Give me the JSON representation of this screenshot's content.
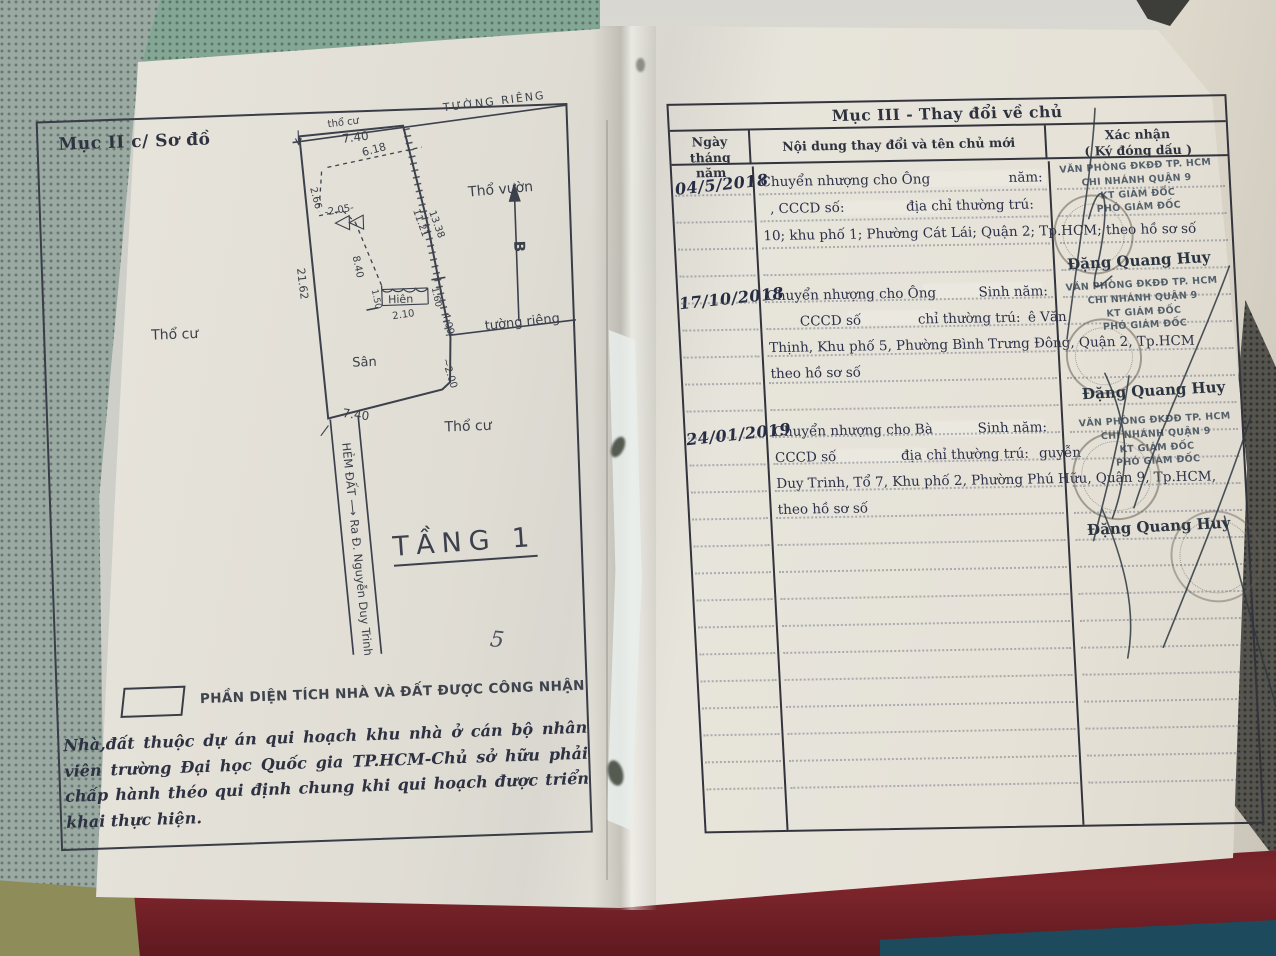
{
  "document_type": "Vietnamese land-use certificate, open booklet photo",
  "colors": {
    "paper": "#e6e2d8",
    "ink": "#2c3048",
    "table_border": "#33343d",
    "stamp_ink": "#40515c",
    "mesh_fabric": "#84a795",
    "red_cloth": "#7e262c",
    "olive_patch": "#8e8c59",
    "teal_patch": "#1d4a5c"
  },
  "left_page": {
    "section_heading": "Mục II c/ Sơ đồ",
    "floor_label": "TẦNG 1",
    "legend_label": "PHẦN DIỆN TÍCH NHÀ VÀ ĐẤT ĐƯỢC CÔNG NHẬN",
    "note": "Nhà,đất thuộc dự án qui hoạch khu nhà ở cán bộ nhân viên trường Đại học Quốc gia TP.HCM-Chủ sở hữu phải chấp hành théo qui định chung khi qui hoạch được triển khai thực hiện.",
    "pen_mark": "5",
    "diagram_labels": [
      {
        "text": "thổ cư",
        "x": 292,
        "y": 32,
        "r": -5,
        "s": 10
      },
      {
        "text": "7.40",
        "x": 306,
        "y": 48,
        "r": -5,
        "s": 12
      },
      {
        "text": "TƯỜNG RIÊNG",
        "x": 408,
        "y": 20,
        "r": -5,
        "s": 11,
        "ls": 2
      },
      {
        "text": "6.18",
        "x": 326,
        "y": 62,
        "r": -13,
        "s": 11
      },
      {
        "text": "2.66",
        "x": 272,
        "y": 92,
        "r": 78,
        "s": 10
      },
      {
        "text": "-2.05-",
        "x": 286,
        "y": 120,
        "r": -8,
        "s": 10
      },
      {
        "text": "8.40",
        "x": 312,
        "y": 162,
        "r": 80,
        "s": 10
      },
      {
        "text": "21.62",
        "x": 256,
        "y": 172,
        "r": 85,
        "s": 11
      },
      {
        "text": "11.21",
        "x": 374,
        "y": 118,
        "r": 72,
        "s": 10
      },
      {
        "text": "13.38",
        "x": 390,
        "y": 120,
        "r": 72,
        "s": 10
      },
      {
        "text": "Thổ vườn",
        "x": 430,
        "y": 106,
        "r": -3,
        "s": 14
      },
      {
        "text": "B",
        "x": 474,
        "y": 152,
        "r": 90,
        "s": 15,
        "b": 1
      },
      {
        "text": "Thổ cư",
        "x": 108,
        "y": 238,
        "r": 0,
        "s": 14
      },
      {
        "text": "Hiên",
        "x": 346,
        "y": 210,
        "r": 0,
        "s": 11
      },
      {
        "text": "1.60",
        "x": 390,
        "y": 196,
        "r": 80,
        "s": 9
      },
      {
        "text": "1.50",
        "x": 330,
        "y": 196,
        "r": 80,
        "s": 9
      },
      {
        "text": "2.10",
        "x": 350,
        "y": 226,
        "r": -6,
        "s": 10
      },
      {
        "text": "4.09",
        "x": 400,
        "y": 222,
        "r": 78,
        "s": 10
      },
      {
        "text": "tường riêng",
        "x": 442,
        "y": 240,
        "r": -4,
        "s": 13
      },
      {
        "text": "Sân",
        "x": 308,
        "y": 272,
        "r": 0,
        "s": 13
      },
      {
        "text": "~2.00",
        "x": 398,
        "y": 268,
        "r": 75,
        "s": 10
      },
      {
        "text": "7.40",
        "x": 296,
        "y": 322,
        "r": 9,
        "s": 12
      },
      {
        "text": "Thổ cư",
        "x": 398,
        "y": 340,
        "r": 0,
        "s": 14
      },
      {
        "text": "HẺM ĐẤT  ⟶  Ra Đ. Nguyễn Duy Trinh",
        "x": 295,
        "y": 348,
        "r": 86,
        "s": 11.5
      }
    ]
  },
  "right_page": {
    "table_title": "Mục III - Thay đổi về chủ",
    "header": {
      "col1a": "Ngày tháng",
      "col1b": "năm",
      "col2": "Nội dung thay đổi và tên chủ mới",
      "col3a": "Xác nhận",
      "col3b": "( Ký đóng dấu )"
    },
    "rows": [
      {
        "date": "04/5/2018",
        "l1a": "Chuyển nhượng cho Ông",
        "l1b": "năm:",
        "l2a": ", CCCD số:",
        "l2b": "địa chỉ thường trú:",
        "l2c": "",
        "l3": "10; khu phố 1; Phường Cát Lái; Quận 2; Tp.HCM; theo hồ sơ số",
        "l4": "",
        "stamp": [
          "VĂN PHÒNG ĐKĐĐ TP. HCM",
          "CHI NHÁNH QUẬN 9",
          "KT GIÁM ĐỐC",
          "PHÓ GIÁM ĐỐC"
        ],
        "signer": "Đặng Quang Huy"
      },
      {
        "date": "17/10/2018",
        "l1a": "Chuyển nhượng cho Ông",
        "l1b": "Sinh năm:",
        "l2a": "CCCD số",
        "l2b": "chỉ thường trú:",
        "l2c": "ê Văn",
        "l3": "Thịnh, Khu phố 5, Phường Bình Trưng Đông, Quận 2, Tp.HCM",
        "l4": "theo hồ sơ số",
        "stamp": [
          "VĂN PHÒNG ĐKĐĐ TP. HCM",
          "CHI NHÁNH QUẬN 9",
          "KT GIÁM ĐỐC",
          "PHÓ GIÁM ĐỐC"
        ],
        "signer": "Đặng Quang Huy"
      },
      {
        "date": "24/01/2019",
        "l1a": "Chuyển nhượng cho Bà",
        "l1b": "Sinh năm:",
        "l2a": "CCCD số",
        "l2b": "địa chỉ thường trú:",
        "l2c": "guyễn",
        "l3": "Duy Trinh, Tổ 7, Khu phố 2, Phường Phú Hữu, Quận 9, Tp.HCM,",
        "l4": "theo hồ sơ số",
        "stamp": [
          "VĂN PHÒNG ĐKĐĐ TP. HCM",
          "CHI NHÁNH QUẬN 9",
          "KT GIÁM ĐỐC",
          "PHÓ GIÁM ĐỐC"
        ],
        "signer": "Đặng Quang Huy"
      }
    ]
  }
}
